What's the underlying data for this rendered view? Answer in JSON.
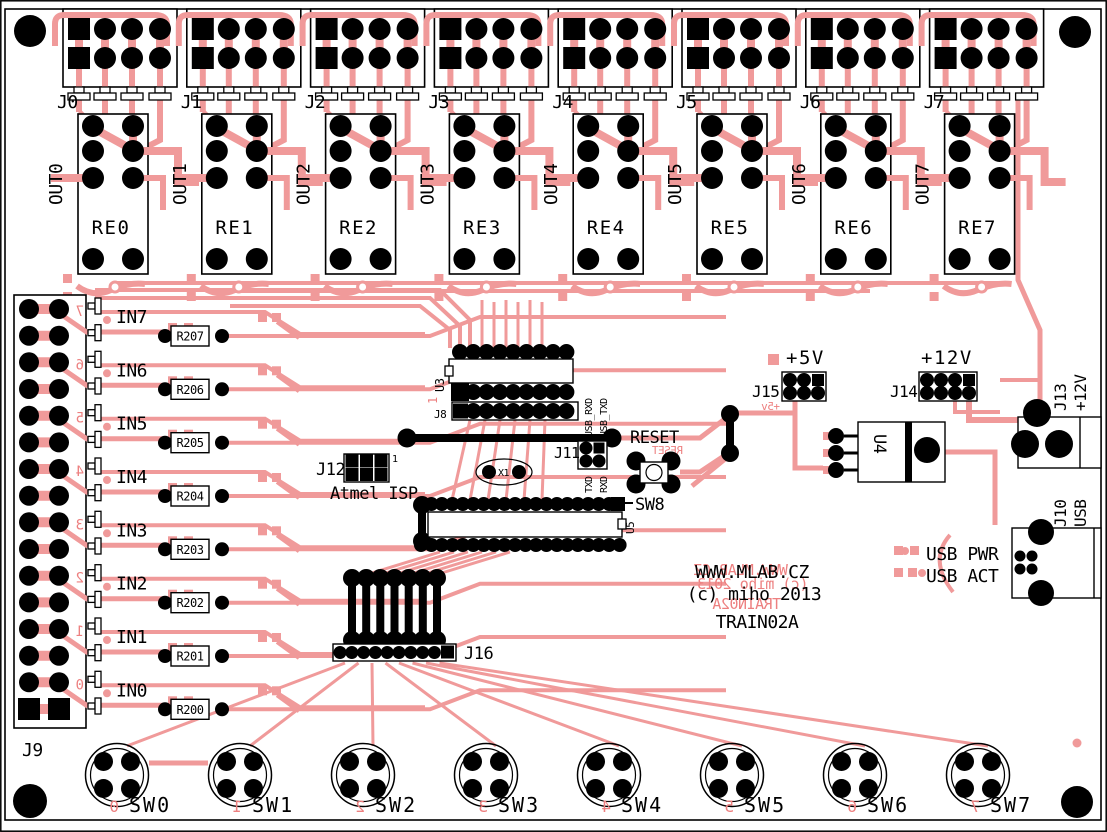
{
  "board": {
    "site": "WWW.MLAB.CZ",
    "copyright": "(c) miho 2013",
    "name": "TRAIN02A",
    "colors": {
      "copper_trace": "#F09A9A",
      "silkscreen_red": "#ED8080",
      "drill_black": "#000000",
      "board_white": "#FFFFFF"
    }
  },
  "top_channels": [
    {
      "connector": "J0",
      "out": "OUT0",
      "relay": "RE0"
    },
    {
      "connector": "J1",
      "out": "OUT1",
      "relay": "RE1"
    },
    {
      "connector": "J2",
      "out": "OUT2",
      "relay": "RE2"
    },
    {
      "connector": "J3",
      "out": "OUT3",
      "relay": "RE3"
    },
    {
      "connector": "J4",
      "out": "OUT4",
      "relay": "RE4"
    },
    {
      "connector": "J5",
      "out": "OUT5",
      "relay": "RE5"
    },
    {
      "connector": "J6",
      "out": "OUT6",
      "relay": "RE6"
    },
    {
      "connector": "J7",
      "out": "OUT7",
      "relay": "RE7"
    }
  ],
  "inputs": [
    {
      "label": "IN7",
      "resistor": "R207",
      "digit": "7"
    },
    {
      "label": "IN6",
      "resistor": "R206",
      "digit": "6"
    },
    {
      "label": "IN5",
      "resistor": "R205",
      "digit": "5"
    },
    {
      "label": "IN4",
      "resistor": "R204",
      "digit": "4"
    },
    {
      "label": "IN3",
      "resistor": "R203",
      "digit": "3"
    },
    {
      "label": "IN2",
      "resistor": "R202",
      "digit": "2"
    },
    {
      "label": "IN1",
      "resistor": "R201",
      "digit": "1"
    },
    {
      "label": "IN0",
      "resistor": "R200",
      "digit": "0"
    }
  ],
  "input_connector": {
    "label": "J9"
  },
  "switches": [
    {
      "label": "SW0",
      "digit": "0"
    },
    {
      "label": "SW1",
      "digit": "1"
    },
    {
      "label": "SW2",
      "digit": "2"
    },
    {
      "label": "SW3",
      "digit": "3"
    },
    {
      "label": "SW4",
      "digit": "4"
    },
    {
      "label": "SW5",
      "digit": "5"
    },
    {
      "label": "SW6",
      "digit": "6"
    },
    {
      "label": "SW7",
      "digit": "7"
    }
  ],
  "mcu": {
    "ref": "U5"
  },
  "logic_ic": {
    "ref": "U3",
    "pin1": "1"
  },
  "header_j8": {
    "label": "J8"
  },
  "isp": {
    "label": "J12",
    "pin1": "1",
    "caption": "Atmel ISP"
  },
  "crystal": {
    "label": "X1"
  },
  "serial_header": {
    "label": "J11",
    "top_left": "USB_RXD",
    "top_right": "USB_TXD",
    "bottom_left": "TXD",
    "bottom_right": "RXD"
  },
  "reset": {
    "label": "RESET",
    "mirror": "RESET",
    "switch": "SW8"
  },
  "jumper_header": {
    "label": "J16"
  },
  "power": {
    "p5_label": "+5V",
    "j15": "J15",
    "p5_mirror": "+5v",
    "p12_label": "+12V",
    "j14": "J14",
    "regulator": "U4",
    "j13": "J13",
    "j13_voltage": "+12V",
    "j10": "J10",
    "j10_type": "USB",
    "usb_pwr": "USB PWR",
    "usb_act": "USB ACT"
  }
}
